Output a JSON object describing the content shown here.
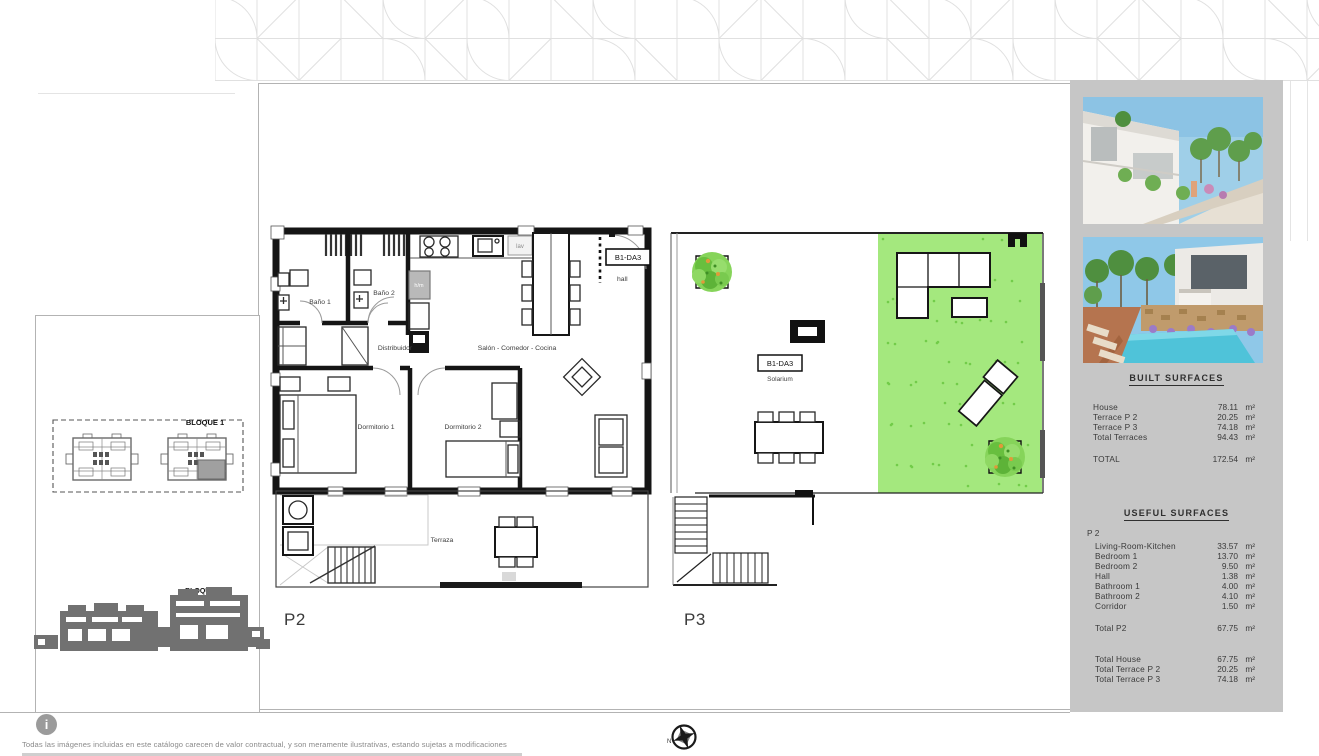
{
  "plans": {
    "p2": {
      "label": "P2",
      "unit_tag": "B1-DA3",
      "rooms": {
        "bano1": "Baño 1",
        "bano2": "Baño 2",
        "distribuidor": "Distribuidor",
        "salon": "Salón - Comedor - Cocina",
        "dormitorio1": "Dormitorio 1",
        "dormitorio2": "Dormitorio 2",
        "hall": "hall",
        "lav": "lav",
        "hm": "h/m",
        "terraza": "Terraza"
      }
    },
    "p3": {
      "label": "P3",
      "unit_tag": "B1-DA3",
      "area_label": "Solarium"
    }
  },
  "site": {
    "block_plan_label": "BLOQUE 1",
    "block_elevation_label": "BLOQUE1"
  },
  "sidebar": {
    "built_surfaces": {
      "title": "BUILT SURFACES",
      "rows": [
        {
          "label": "House",
          "value": "78.11",
          "unit": "m²"
        },
        {
          "label": "Terrace P 2",
          "value": "20.25",
          "unit": "m²"
        },
        {
          "label": "Terrace P 3",
          "value": "74.18",
          "unit": "m²"
        },
        {
          "label": "Total Terraces",
          "value": "94.43",
          "unit": "m²"
        }
      ],
      "total": {
        "label": "TOTAL",
        "value": "172.54",
        "unit": "m²"
      }
    },
    "useful_surfaces": {
      "title": "USEFUL SURFACES",
      "group_label": "P 2",
      "rows": [
        {
          "label": "Living-Room-Kitchen",
          "value": "33.57",
          "unit": "m²"
        },
        {
          "label": "Bedroom 1",
          "value": "13.70",
          "unit": "m²"
        },
        {
          "label": "Bedroom 2",
          "value": "9.50",
          "unit": "m²"
        },
        {
          "label": "Hall",
          "value": "1.38",
          "unit": "m²"
        },
        {
          "label": "Bathroom 1",
          "value": "4.00",
          "unit": "m²"
        },
        {
          "label": "Bathroom 2",
          "value": "4.10",
          "unit": "m²"
        },
        {
          "label": "Corridor",
          "value": "1.50",
          "unit": "m²"
        }
      ],
      "subtotal": {
        "label": "Total P2",
        "value": "67.75",
        "unit": "m²"
      },
      "totals": [
        {
          "label": "Total House",
          "value": "67.75",
          "unit": "m²"
        },
        {
          "label": "Total Terrace P 2",
          "value": "20.25",
          "unit": "m²"
        },
        {
          "label": "Total Terrace P 3",
          "value": "74.18",
          "unit": "m²"
        }
      ]
    }
  },
  "footer": {
    "disclaimer": "Todas las imágenes incluidas en este catálogo carecen de valor contractual, y son meramente ilustrativas, estando sujetas a modificaciones",
    "compass_north": "N"
  },
  "colors": {
    "lawn": "#a4e87e",
    "lawn_speckle": "#72cc49",
    "sidebar_bg": "#c6c6c6"
  }
}
